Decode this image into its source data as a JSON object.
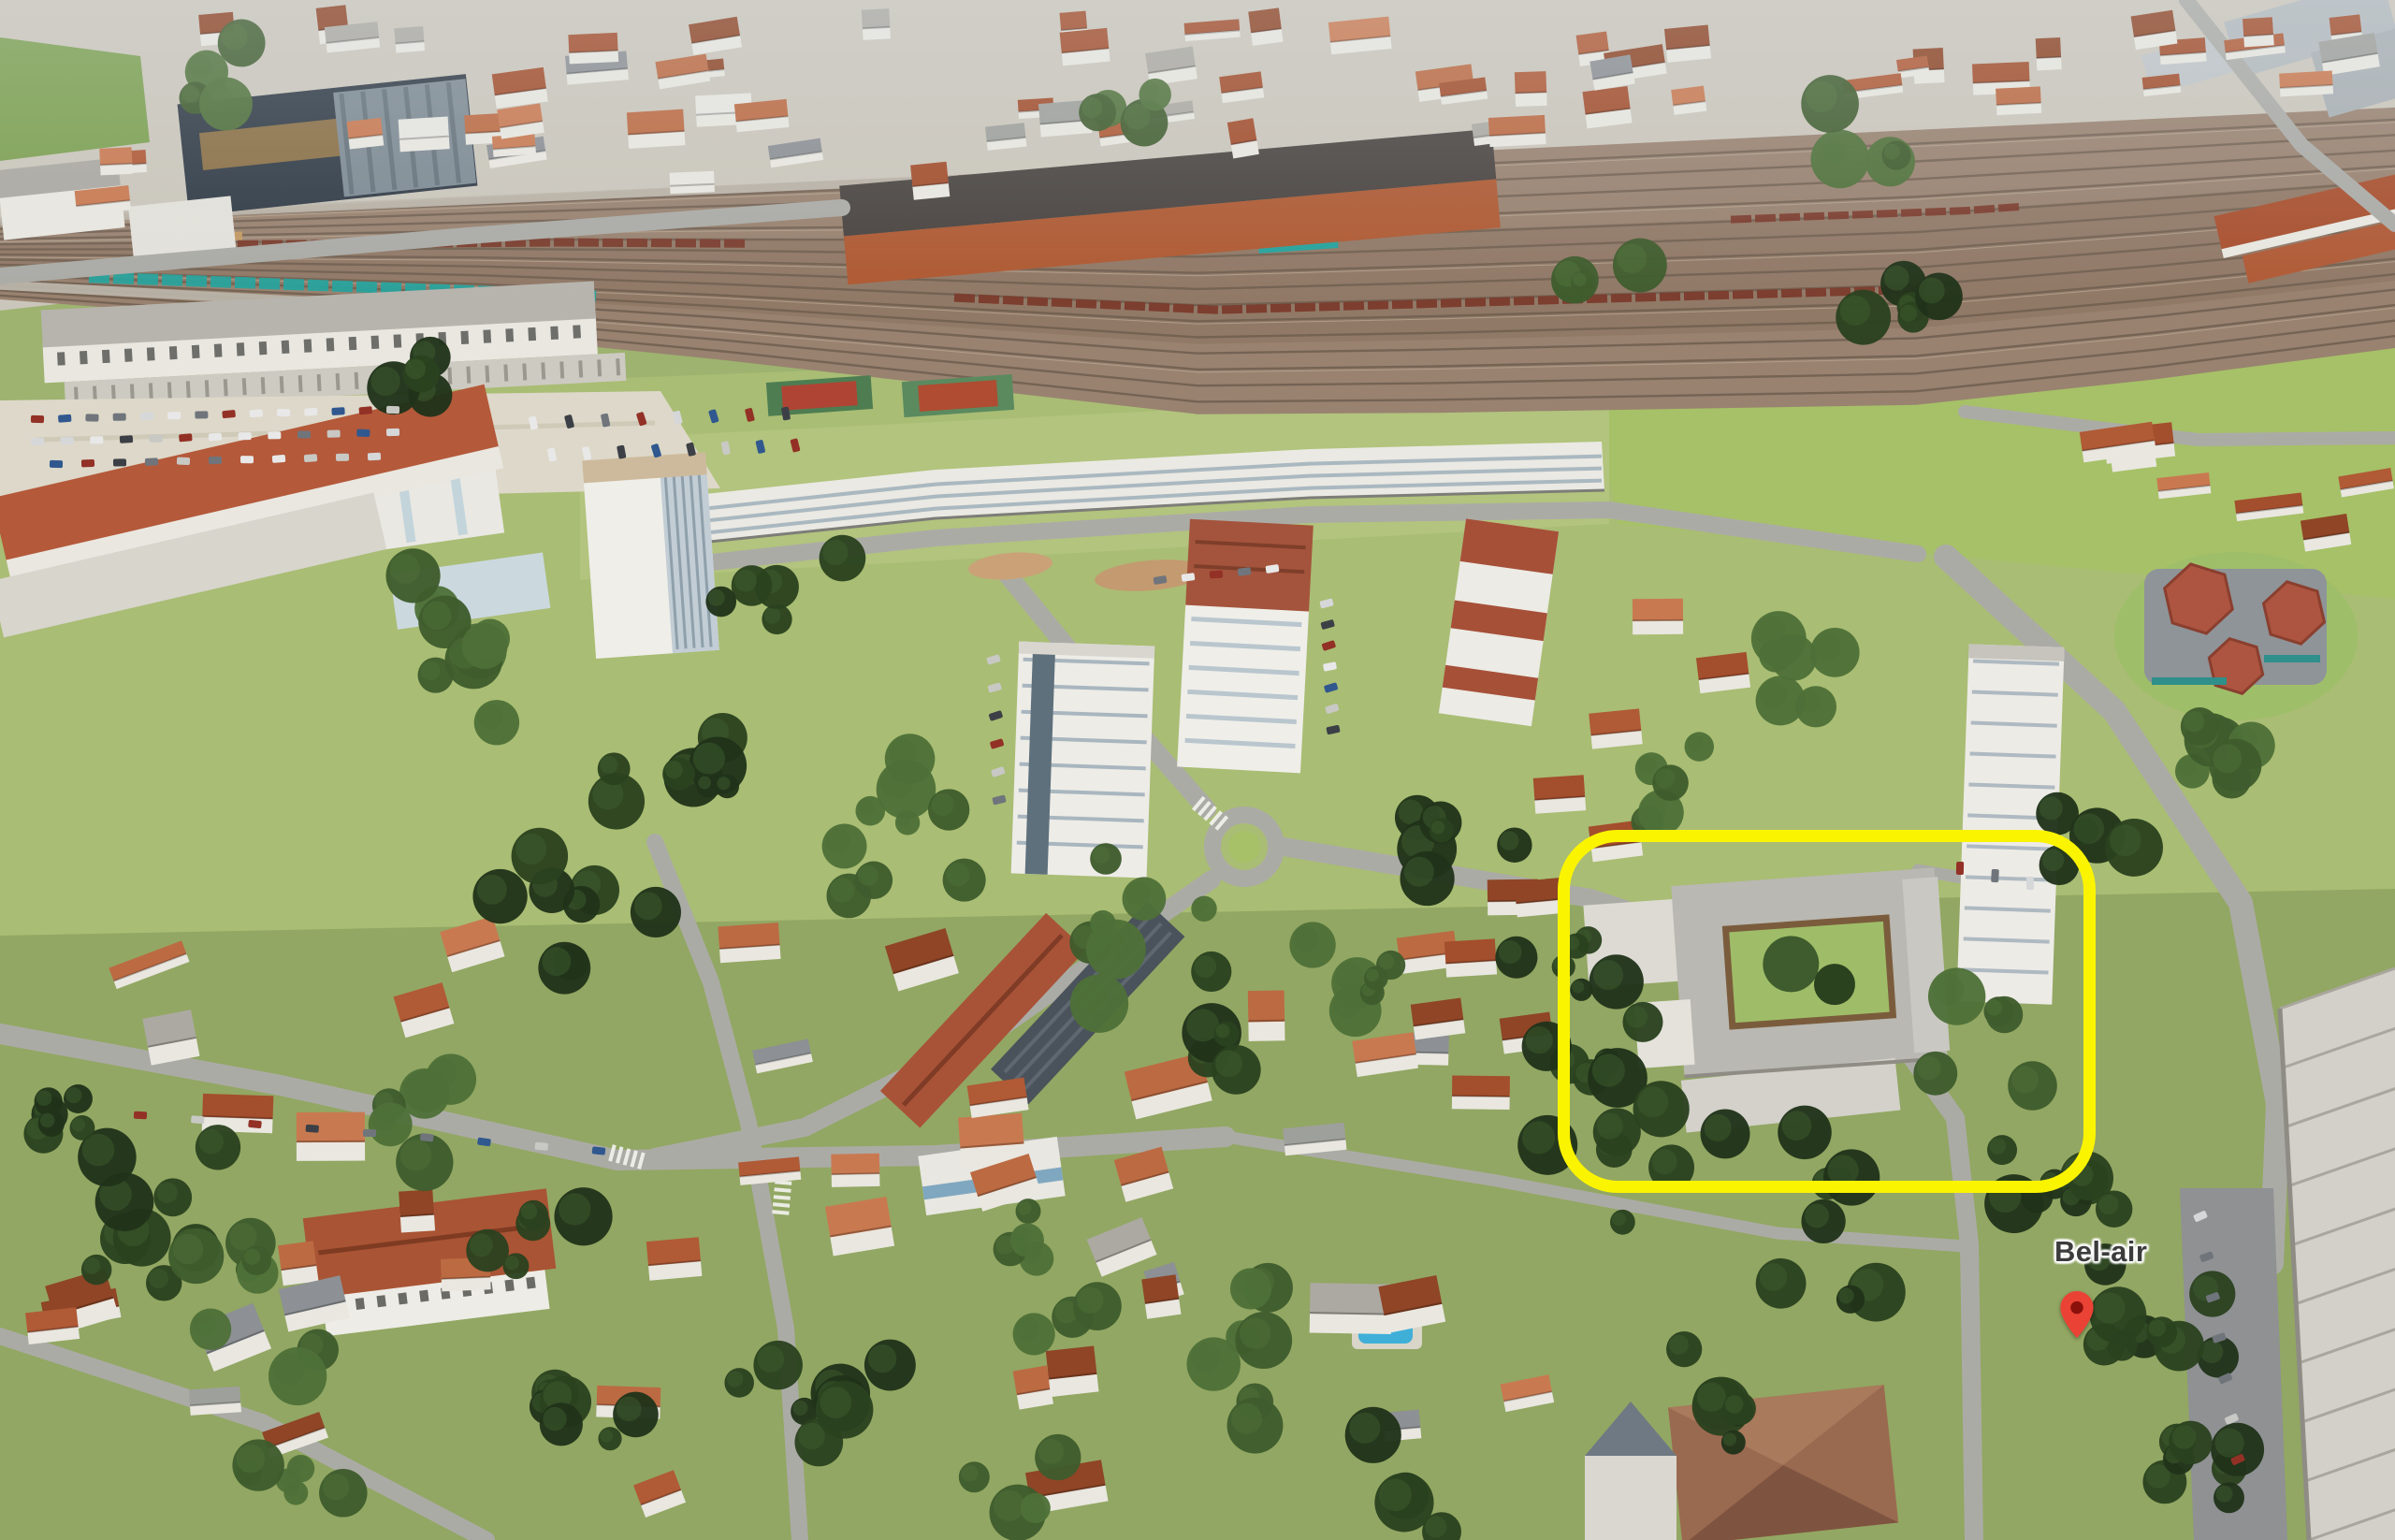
{
  "poi": {
    "label": "Bel-air",
    "pin_color": "#EA4335",
    "pin_inner_color": "#8A100B",
    "label_text_color": "#3C3C3C",
    "label_halo_color": "#FFFFFF"
  },
  "annotation": {
    "highlight_color": "#FBF400"
  },
  "scene": {
    "palette": {
      "field_green": "#9DB36F",
      "park_green": "#A9BD74",
      "south_green": "#92A763",
      "lawn_bright": "#A6C167",
      "lawn_pale": "#B2C47D",
      "tree_dark": "#2B421F",
      "tree_darker": "#20331A",
      "tree_mid": "#3E5C2D",
      "tree_light": "#4E7038",
      "urban_base": "#CBC6BB",
      "plaza": "#DDD8C9",
      "road": "#ABABA6",
      "road_light": "#C2C2BD",
      "ballast": "#998270",
      "ballast_dark": "#8A7361",
      "track_dark": "#6F5E4F",
      "track_light": "#B7A591",
      "freight_red": "#7B3B2C",
      "teal_train": "#27A29C",
      "loco_tan": "#C49A62",
      "wall_white": "#E9E7E0",
      "building_white": "#EFEEE9",
      "roof_gray": "#B7B4AD",
      "facade_shade": "#C2CDD5",
      "glass_dark": "#5E707C",
      "roof_tiles": [
        "#B05A36",
        "#A34E2C",
        "#BC6A42",
        "#C97950",
        "#8F4526"
      ],
      "roof_gray_tiles": [
        "#9EA09B",
        "#8D9094",
        "#ACA9A2"
      ],
      "dark_building": "#313B46",
      "bronze_roof": "#8A6F45",
      "steel_roof": "#7E8A93",
      "school_roof": "#A95434",
      "slab_red": "#A85337",
      "slab_dark": "#4A525B",
      "villa_roof": "#9A6A50",
      "church_roof": "#6F7983",
      "kindergarten_roof": "#AD5540",
      "teal_trim": "#2F8F8A",
      "pool_blue": "#3FAFD8",
      "pool_light": "#7FD0EA",
      "right_slab": "#D3D0C9",
      "panel_line": "#A9A69E",
      "parking": "#8F9193",
      "car_colors": [
        "#E8E8E8",
        "#D5D7D9",
        "#3C4046",
        "#70757C",
        "#933126",
        "#30588F",
        "#C8C8C4"
      ],
      "haze": "#DDE6EC"
    }
  }
}
